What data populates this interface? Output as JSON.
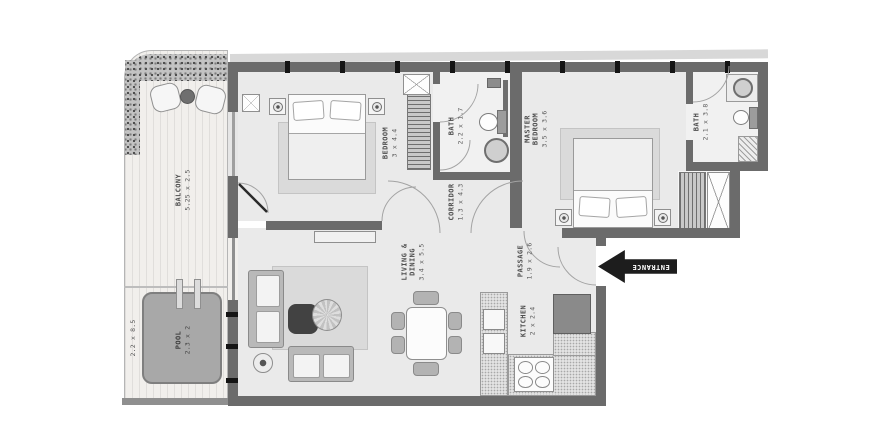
{
  "floorplan": {
    "balcony": {
      "name": "BALCONY",
      "dims": "5.25 x 2.5"
    },
    "pool": {
      "name": "POOL",
      "dims": "2.3 x 2"
    },
    "pool_deck": {
      "dims": "2.2 x 8.5"
    },
    "bedroom": {
      "name": "BEDROOM",
      "dims": "3 x 4.4"
    },
    "bath": {
      "name": "BATH",
      "dims": "2.2 x 1.7"
    },
    "master_bedroom": {
      "name": "MASTER BEDROOM",
      "dims": "3.5 x 3.6"
    },
    "master_bath": {
      "name": "BATH",
      "dims": "2.1 x 3.8"
    },
    "corridor": {
      "name": "CORRIDOR",
      "dims": "1.3 x 4.3"
    },
    "living_dining": {
      "name": "LIVING & DINING",
      "dims": "3.4 x 5.5"
    },
    "passage": {
      "name": "PASSAGE",
      "dims": "1.9 x 2.6"
    },
    "kitchen": {
      "name": "KITCHEN",
      "dims": "2 x 2.4"
    },
    "entrance": {
      "name": "ENTRANCE"
    }
  },
  "colors": {
    "wall": "#6b6b6b",
    "room": "#eaeaea",
    "bathroom": "#f1f1f1",
    "rug": "#dadada",
    "deck": "#f1efec",
    "pool": "#a8a8a8",
    "entrance": "#1d1d1d"
  }
}
